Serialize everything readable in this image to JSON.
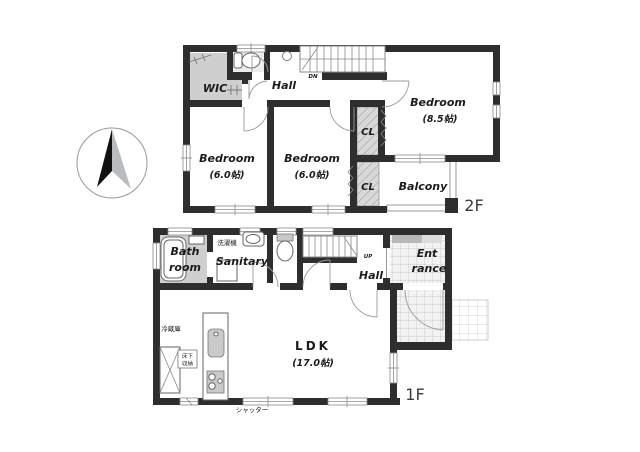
{
  "palette": {
    "wall": "#2e2e2e",
    "room_gray": "#cfcfcf",
    "closet_hatch_gray": "#d8d8d8",
    "toilet_room_gray": "#ededed",
    "shoe_cabinet_gray": "#b8b8b8",
    "tile_line_gray": "#c0c0c0",
    "text": "#1b1b1b",
    "compass_black": "#111111",
    "compass_gray": "#b8bcc0"
  },
  "floor2": {
    "floor_label": "2F",
    "stairs": "DN",
    "rooms": {
      "wic": "WIC",
      "hall": "Hall",
      "bedroom_main": {
        "name": "Bedroom",
        "size": "(8.5帖)"
      },
      "bedroom_left": {
        "name": "Bedroom",
        "size": "(6.0帖)"
      },
      "bedroom_center": {
        "name": "Bedroom",
        "size": "(6.0帖)"
      },
      "closet_upper": "CL",
      "closet_lower": "CL",
      "balcony": "Balcony"
    }
  },
  "floor1": {
    "floor_label": "1F",
    "stairs": "UP",
    "rooms": {
      "bathroom": {
        "line1": "Bath",
        "line2": "room"
      },
      "sanitary": "Sanitary",
      "hall": "Hall",
      "entrance": {
        "line1": "Ent",
        "line2": "rance"
      },
      "ldk": {
        "name": "LDK",
        "size": "(17.0帖)"
      }
    },
    "annotations": {
      "washing_machine": "洗濯機",
      "refrigerator": "冷蔵庫",
      "underfloor_storage_line1": "床下",
      "underfloor_storage_line2": "収納",
      "shutter": "シャッター"
    }
  }
}
